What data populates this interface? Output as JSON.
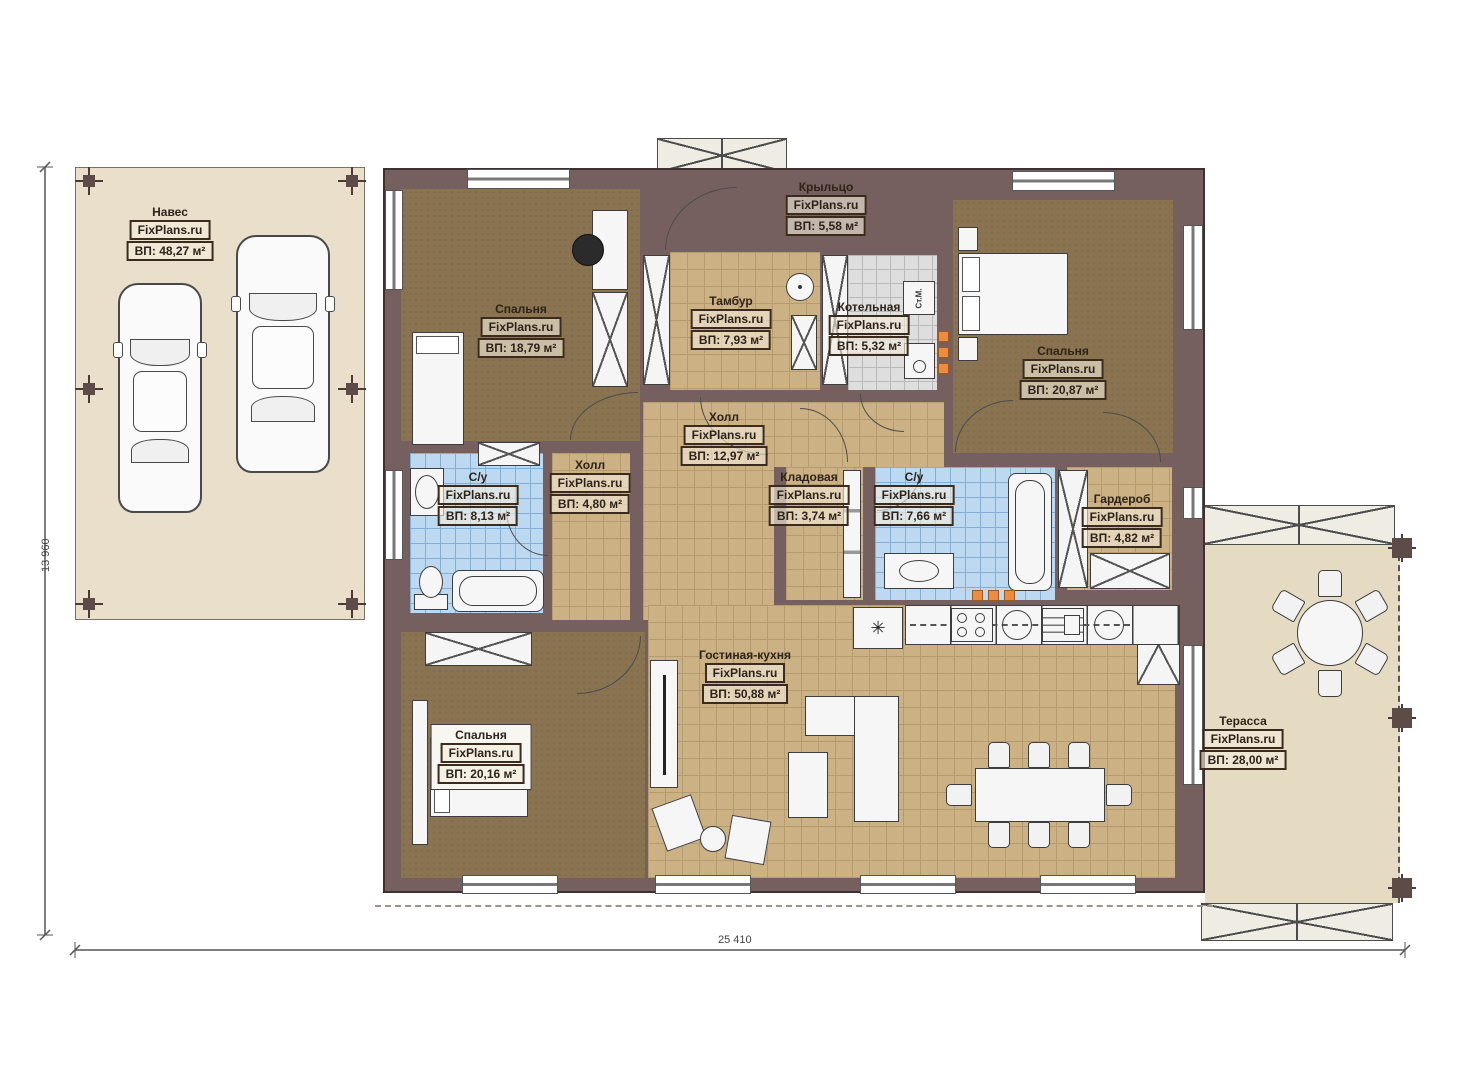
{
  "watermark": "FixPlans.ru",
  "rooms": [
    {
      "id": "naves",
      "name": "Навес",
      "area": "ВП: 48,27 м²"
    },
    {
      "id": "kryltso",
      "name": "Крыльцо",
      "area": "ВП: 5,58 м²"
    },
    {
      "id": "bedroom1",
      "name": "Спальня",
      "area": "ВП: 18,79 м²"
    },
    {
      "id": "tambur",
      "name": "Тамбур",
      "area": "ВП: 7,93 м²"
    },
    {
      "id": "kotelnaya",
      "name": "Котельная",
      "area": "ВП: 5,32 м²"
    },
    {
      "id": "bedroom2",
      "name": "Спальня",
      "area": "ВП: 20,87 м²"
    },
    {
      "id": "holl",
      "name": "Холл",
      "area": "ВП: 12,97 м²"
    },
    {
      "id": "su1",
      "name": "С/у",
      "area": "ВП: 8,13 м²"
    },
    {
      "id": "holl2",
      "name": "Холл",
      "area": "ВП: 4,80 м²"
    },
    {
      "id": "kladovaya",
      "name": "Кладовая",
      "area": "ВП: 3,74 м²"
    },
    {
      "id": "su2",
      "name": "С/у",
      "area": "ВП: 7,66 м²"
    },
    {
      "id": "garderob",
      "name": "Гардероб",
      "area": "ВП: 4,82 м²"
    },
    {
      "id": "living",
      "name": "Гостиная-кухня",
      "area": "ВП: 50,88 м²"
    },
    {
      "id": "bedroom3",
      "name": "Спальня",
      "area": "ВП: 20,16 м²"
    },
    {
      "id": "terrace",
      "name": "Терасса",
      "area": "ВП: 28,00 м²"
    }
  ],
  "labels": {
    "washing_machine": "Ст.М.",
    "fridge_icon": "✳"
  },
  "dimensions": {
    "width": "25 410",
    "height": "13 960"
  },
  "colors": {
    "wall": "#75605f",
    "outdoor": "#e9dfca",
    "floor_tan": "#cbb184",
    "floor_brown": "#8a7350",
    "floor_blue": "#bdd8f1",
    "floor_gray": "#dedede",
    "accent_orange": "#ec8c42"
  }
}
